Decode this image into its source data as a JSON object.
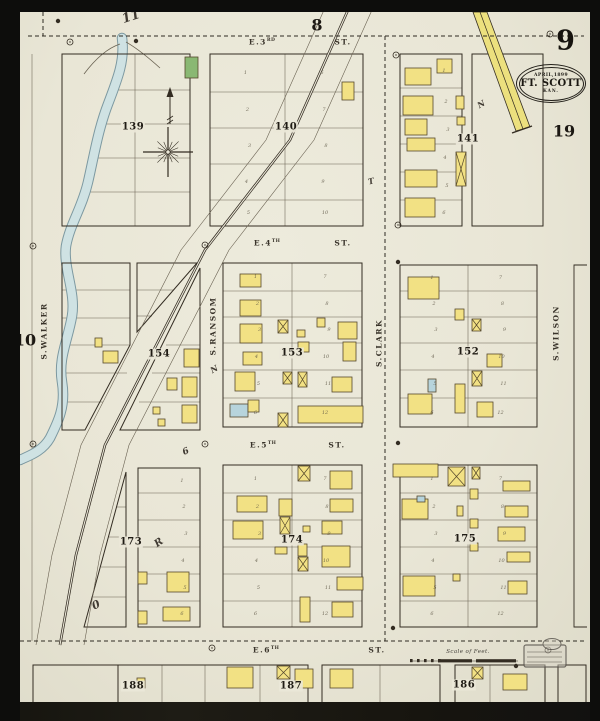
{
  "meta": {
    "sheet_number": "9",
    "adjacent_sheets": {
      "top": "8",
      "right": "19",
      "left": "10"
    },
    "stamp": {
      "date": "APRIL,1899",
      "city": "FT. SCOTT",
      "state": "KAN."
    }
  },
  "scale": {
    "label": "Scale of Feet."
  },
  "streets": {
    "horizontal": [
      {
        "prefix": "E.3",
        "ordinal": "RD",
        "suffix": "ST.",
        "name_x": 262,
        "suffix_x": 343,
        "y": 42
      },
      {
        "prefix": "E.4",
        "ordinal": "TH",
        "suffix": "ST.",
        "name_x": 267,
        "suffix_x": 343,
        "y": 243
      },
      {
        "prefix": "E.5",
        "ordinal": "TH",
        "suffix": "ST.",
        "name_x": 263,
        "suffix_x": 337,
        "y": 445
      },
      {
        "prefix": "E.6",
        "ordinal": "TH",
        "suffix": "ST.",
        "name_x": 266,
        "suffix_x": 377,
        "y": 650
      }
    ],
    "vertical": [
      {
        "name": "S.WALKER",
        "x": 44,
        "y": 331
      },
      {
        "name": "S.RANSOM",
        "x": 213,
        "y": 326
      },
      {
        "name": "S.CLARK",
        "x": 379,
        "y": 343
      },
      {
        "name": "S.WILSON",
        "x": 556,
        "y": 333
      }
    ]
  },
  "block_labels": [
    {
      "id": "139",
      "x": 133,
      "y": 127
    },
    {
      "id": "140",
      "x": 286,
      "y": 127
    },
    {
      "id": "141",
      "x": 468,
      "y": 139
    },
    {
      "id": "154",
      "x": 159,
      "y": 354
    },
    {
      "id": "153",
      "x": 292,
      "y": 353
    },
    {
      "id": "152",
      "x": 468,
      "y": 352
    },
    {
      "id": "173",
      "x": 131,
      "y": 542
    },
    {
      "id": "174",
      "x": 292,
      "y": 540
    },
    {
      "id": "175",
      "x": 465,
      "y": 539
    },
    {
      "id": "188",
      "x": 133,
      "y": 686
    },
    {
      "id": "187",
      "x": 291,
      "y": 686
    },
    {
      "id": "186",
      "x": 464,
      "y": 685
    }
  ],
  "pen_marks": [
    {
      "t": "11",
      "x": 131,
      "y": 17,
      "s": 13,
      "r": -18
    },
    {
      "t": "N",
      "x": 481,
      "y": 104,
      "s": 8,
      "r": -30
    },
    {
      "t": "T",
      "x": 371,
      "y": 181,
      "s": 8,
      "r": -15
    },
    {
      "t": "N",
      "x": 214,
      "y": 369,
      "s": 8,
      "r": -30
    },
    {
      "t": "6",
      "x": 186,
      "y": 452,
      "s": 9,
      "r": -25
    },
    {
      "t": "R",
      "x": 159,
      "y": 543,
      "s": 10,
      "r": -35
    },
    {
      "t": "0",
      "x": 96,
      "y": 605,
      "s": 11,
      "r": -25
    }
  ],
  "colors": {
    "paper": "#eae7d8",
    "ink": "#332c22",
    "line": "#6a6252",
    "yellow": "#f2e184",
    "yellow_stroke": "#55482c",
    "green": "#8ab873",
    "blue": "#b7d4dc",
    "creek": "#cfe2e3",
    "creek_edge": "#7c98a0",
    "rr_yellow": "#ece07e",
    "dashed": "#2e2a22"
  },
  "geometry": {
    "rect_blocks": [
      {
        "x": 62,
        "y": 54,
        "w": 128,
        "h": 172
      },
      {
        "x": 210,
        "y": 54,
        "w": 153,
        "h": 172,
        "hl": [
          92,
          128,
          164,
          200
        ],
        "div": 285,
        "nums": true
      },
      {
        "x": 400,
        "y": 54,
        "w": 62,
        "h": 172,
        "hl": [
          88,
          116,
          144,
          172,
          200
        ],
        "nums": true
      },
      {
        "x": 472,
        "y": 54,
        "w": 71,
        "h": 172
      },
      {
        "x": 223,
        "y": 263,
        "w": 139,
        "h": 164,
        "hl": [
          291,
          317,
          343,
          370,
          398
        ],
        "div": 292,
        "nums": true
      },
      {
        "x": 400,
        "y": 265,
        "w": 137,
        "h": 162,
        "hl": [
          291,
          317,
          343,
          370,
          398
        ],
        "div": 468,
        "nums": true
      },
      {
        "x": 138,
        "y": 468,
        "w": 62,
        "h": 159,
        "hl": [
          493,
          520,
          547,
          574,
          601
        ],
        "nums": true
      },
      {
        "x": 223,
        "y": 465,
        "w": 139,
        "h": 162,
        "hl": [
          493,
          520,
          547,
          574,
          601
        ],
        "div": 292,
        "nums": true
      },
      {
        "x": 400,
        "y": 465,
        "w": 137,
        "h": 162,
        "hl": [
          493,
          520,
          547,
          574,
          601
        ],
        "div": 468,
        "nums": true
      },
      {
        "x": 574,
        "y": 265,
        "w": 13,
        "h": 362,
        "open": true
      },
      {
        "x": 33,
        "y": 665,
        "w": 85,
        "h": 39
      },
      {
        "x": 118,
        "y": 665,
        "w": 190,
        "h": 39,
        "vl": [
          162,
          205,
          260
        ]
      },
      {
        "x": 322,
        "y": 665,
        "w": 118,
        "h": 39,
        "vl": [
          380
        ]
      },
      {
        "x": 455,
        "y": 665,
        "w": 90,
        "h": 39,
        "vl": [
          490
        ]
      },
      {
        "x": 558,
        "y": 665,
        "w": 28,
        "h": 39
      }
    ],
    "poly_blocks": [
      [
        [
          62,
          263
        ],
        [
          130,
          263
        ],
        [
          130,
          345
        ],
        [
          85,
          430
        ],
        [
          62,
          430
        ]
      ],
      [
        [
          137,
          263
        ],
        [
          197,
          263
        ],
        [
          137,
          332
        ]
      ],
      [
        [
          200,
          268
        ],
        [
          200,
          430
        ],
        [
          120,
          430
        ]
      ],
      [
        [
          126,
          472
        ],
        [
          126,
          627
        ],
        [
          84,
          627
        ]
      ]
    ],
    "segments": [
      [
        112,
        90,
        190,
        90
      ],
      [
        104,
        124,
        190,
        124
      ],
      [
        96,
        158,
        190,
        158
      ],
      [
        88,
        192,
        190,
        192
      ],
      [
        135,
        54,
        135,
        226
      ],
      [
        62,
        290,
        130,
        290
      ],
      [
        62,
        318,
        130,
        318
      ],
      [
        62,
        345,
        130,
        345
      ],
      [
        62,
        373,
        127,
        373
      ],
      [
        62,
        402,
        103,
        402
      ],
      [
        137,
        290,
        174,
        290
      ],
      [
        137,
        316,
        152,
        316
      ],
      [
        166,
        345,
        200,
        345
      ],
      [
        152,
        373,
        200,
        373
      ],
      [
        139,
        402,
        200,
        402
      ],
      [
        116,
        507,
        126,
        507
      ],
      [
        109,
        537,
        126,
        537
      ],
      [
        101,
        567,
        126,
        567
      ],
      [
        93,
        597,
        126,
        597
      ],
      [
        32,
        54,
        32,
        641
      ]
    ],
    "dashed": [
      [
        28,
        36,
        584,
        36
      ],
      [
        20,
        641,
        584,
        641
      ],
      [
        385,
        36,
        385,
        641
      ],
      [
        43,
        12,
        43,
        36
      ]
    ],
    "railroad": {
      "center": [
        [
          348,
          10
        ],
        [
          290,
          140
        ],
        [
          205,
          250
        ],
        [
          105,
          445
        ],
        [
          76,
          555
        ],
        [
          60,
          645
        ]
      ],
      "offset": 24,
      "band": "473,12 487,12 530,127 516,131",
      "band_center": [
        480,
        12,
        523,
        129
      ],
      "end_tick": [
        512,
        133,
        532,
        126
      ]
    },
    "creek_path": "M122,38 C125,60 118,78 108,104 C98,130 94,156 88,182 C82,208 70,224 66,246 C63,268 76,292 72,316 C68,340 58,358 62,382 C66,406 58,422 50,438 C42,452 28,456 20,460",
    "hill_flares": [
      "M84,74 Q102,50 120,44",
      "M160,68 Q140,50 126,42"
    ],
    "buildings": [
      [
        185,
        57,
        13,
        21,
        "g"
      ],
      [
        342,
        82,
        12,
        18,
        "y"
      ],
      [
        405,
        68,
        26,
        17,
        "y"
      ],
      [
        437,
        59,
        15,
        14,
        "y"
      ],
      [
        403,
        96,
        30,
        19,
        "y"
      ],
      [
        456,
        96,
        8,
        13,
        "y"
      ],
      [
        405,
        119,
        22,
        16,
        "y"
      ],
      [
        457,
        117,
        8,
        8,
        "y"
      ],
      [
        407,
        138,
        28,
        13,
        "y"
      ],
      [
        456,
        152,
        10,
        34,
        "x"
      ],
      [
        405,
        170,
        32,
        17,
        "y"
      ],
      [
        405,
        198,
        30,
        19,
        "y"
      ],
      [
        95,
        338,
        7,
        9,
        "y"
      ],
      [
        103,
        351,
        15,
        12,
        "y"
      ],
      [
        184,
        349,
        15,
        18,
        "y"
      ],
      [
        167,
        378,
        10,
        12,
        "y"
      ],
      [
        182,
        377,
        15,
        20,
        "y"
      ],
      [
        153,
        407,
        7,
        7,
        "y"
      ],
      [
        182,
        405,
        15,
        18,
        "y"
      ],
      [
        158,
        419,
        7,
        7,
        "y"
      ],
      [
        240,
        274,
        21,
        13,
        "y"
      ],
      [
        240,
        300,
        21,
        16,
        "y"
      ],
      [
        240,
        324,
        22,
        19,
        "y"
      ],
      [
        278,
        320,
        10,
        13,
        "x"
      ],
      [
        297,
        330,
        8,
        7,
        "y"
      ],
      [
        317,
        318,
        8,
        9,
        "y"
      ],
      [
        338,
        322,
        19,
        17,
        "y"
      ],
      [
        243,
        352,
        19,
        13,
        "y"
      ],
      [
        298,
        342,
        11,
        10,
        "y"
      ],
      [
        343,
        342,
        13,
        19,
        "y"
      ],
      [
        235,
        372,
        20,
        19,
        "y"
      ],
      [
        283,
        372,
        9,
        12,
        "x"
      ],
      [
        298,
        372,
        9,
        15,
        "x"
      ],
      [
        332,
        377,
        20,
        15,
        "y"
      ],
      [
        230,
        404,
        18,
        13,
        "b"
      ],
      [
        248,
        400,
        11,
        12,
        "y"
      ],
      [
        298,
        406,
        65,
        17,
        "y"
      ],
      [
        278,
        413,
        10,
        14,
        "x"
      ],
      [
        408,
        277,
        31,
        22,
        "y"
      ],
      [
        455,
        309,
        9,
        11,
        "y"
      ],
      [
        472,
        319,
        9,
        12,
        "x"
      ],
      [
        487,
        354,
        15,
        13,
        "y"
      ],
      [
        472,
        371,
        10,
        15,
        "x"
      ],
      [
        428,
        379,
        8,
        13,
        "b"
      ],
      [
        455,
        384,
        10,
        29,
        "y"
      ],
      [
        408,
        394,
        24,
        20,
        "y"
      ],
      [
        477,
        402,
        16,
        15,
        "y"
      ],
      [
        138,
        572,
        9,
        12,
        "y"
      ],
      [
        167,
        572,
        22,
        20,
        "y"
      ],
      [
        138,
        611,
        9,
        13,
        "y"
      ],
      [
        163,
        607,
        27,
        14,
        "y"
      ],
      [
        237,
        496,
        30,
        16,
        "y"
      ],
      [
        279,
        499,
        13,
        17,
        "y"
      ],
      [
        233,
        521,
        30,
        18,
        "y"
      ],
      [
        280,
        517,
        10,
        17,
        "x"
      ],
      [
        275,
        547,
        12,
        7,
        "y"
      ],
      [
        298,
        466,
        12,
        15,
        "x"
      ],
      [
        330,
        471,
        22,
        18,
        "y"
      ],
      [
        330,
        499,
        23,
        13,
        "y"
      ],
      [
        303,
        526,
        7,
        6,
        "y"
      ],
      [
        322,
        521,
        20,
        13,
        "y"
      ],
      [
        298,
        544,
        9,
        12,
        "y"
      ],
      [
        322,
        546,
        28,
        21,
        "y"
      ],
      [
        298,
        557,
        10,
        14,
        "x"
      ],
      [
        337,
        577,
        26,
        13,
        "y"
      ],
      [
        300,
        597,
        10,
        25,
        "y"
      ],
      [
        332,
        602,
        21,
        15,
        "y"
      ],
      [
        393,
        464,
        45,
        13,
        "y"
      ],
      [
        448,
        467,
        17,
        19,
        "x"
      ],
      [
        472,
        467,
        8,
        12,
        "x"
      ],
      [
        503,
        481,
        27,
        10,
        "y"
      ],
      [
        402,
        499,
        26,
        20,
        "y"
      ],
      [
        417,
        496,
        8,
        6,
        "b"
      ],
      [
        470,
        489,
        8,
        10,
        "y"
      ],
      [
        457,
        506,
        6,
        10,
        "y"
      ],
      [
        505,
        506,
        23,
        11,
        "y"
      ],
      [
        470,
        519,
        8,
        9,
        "y"
      ],
      [
        498,
        527,
        27,
        14,
        "y"
      ],
      [
        470,
        543,
        8,
        8,
        "y"
      ],
      [
        507,
        552,
        23,
        10,
        "y"
      ],
      [
        403,
        576,
        32,
        20,
        "y"
      ],
      [
        453,
        574,
        7,
        7,
        "y"
      ],
      [
        508,
        581,
        19,
        13,
        "y"
      ],
      [
        137,
        678,
        8,
        10,
        "y"
      ],
      [
        227,
        667,
        26,
        21,
        "y"
      ],
      [
        277,
        666,
        13,
        13,
        "x"
      ],
      [
        295,
        669,
        18,
        19,
        "y"
      ],
      [
        330,
        669,
        23,
        19,
        "y"
      ],
      [
        472,
        667,
        11,
        12,
        "x"
      ],
      [
        503,
        674,
        24,
        16,
        "y"
      ]
    ],
    "markers": [
      [
        70,
        42
      ],
      [
        550,
        34
      ],
      [
        396,
        55
      ],
      [
        398,
        225
      ],
      [
        205,
        245
      ],
      [
        33,
        246
      ],
      [
        205,
        444
      ],
      [
        33,
        444
      ],
      [
        212,
        648
      ],
      [
        548,
        650
      ]
    ],
    "dots": [
      [
        58,
        21
      ],
      [
        136,
        41
      ],
      [
        398,
        262
      ],
      [
        398,
        443
      ],
      [
        393,
        628
      ],
      [
        516,
        666
      ]
    ],
    "compass": {
      "cx": 168,
      "cy": 152,
      "arrow": [
        170,
        124,
        170,
        94
      ]
    },
    "scalebar": {
      "x": 410,
      "y": 661,
      "ticks": [
        0,
        7,
        14,
        21,
        28
      ],
      "bars": [
        [
          28,
          34
        ],
        [
          66,
          40
        ]
      ]
    },
    "received_stamp": {
      "x": 524,
      "y": 645,
      "w": 42,
      "h": 22
    }
  }
}
